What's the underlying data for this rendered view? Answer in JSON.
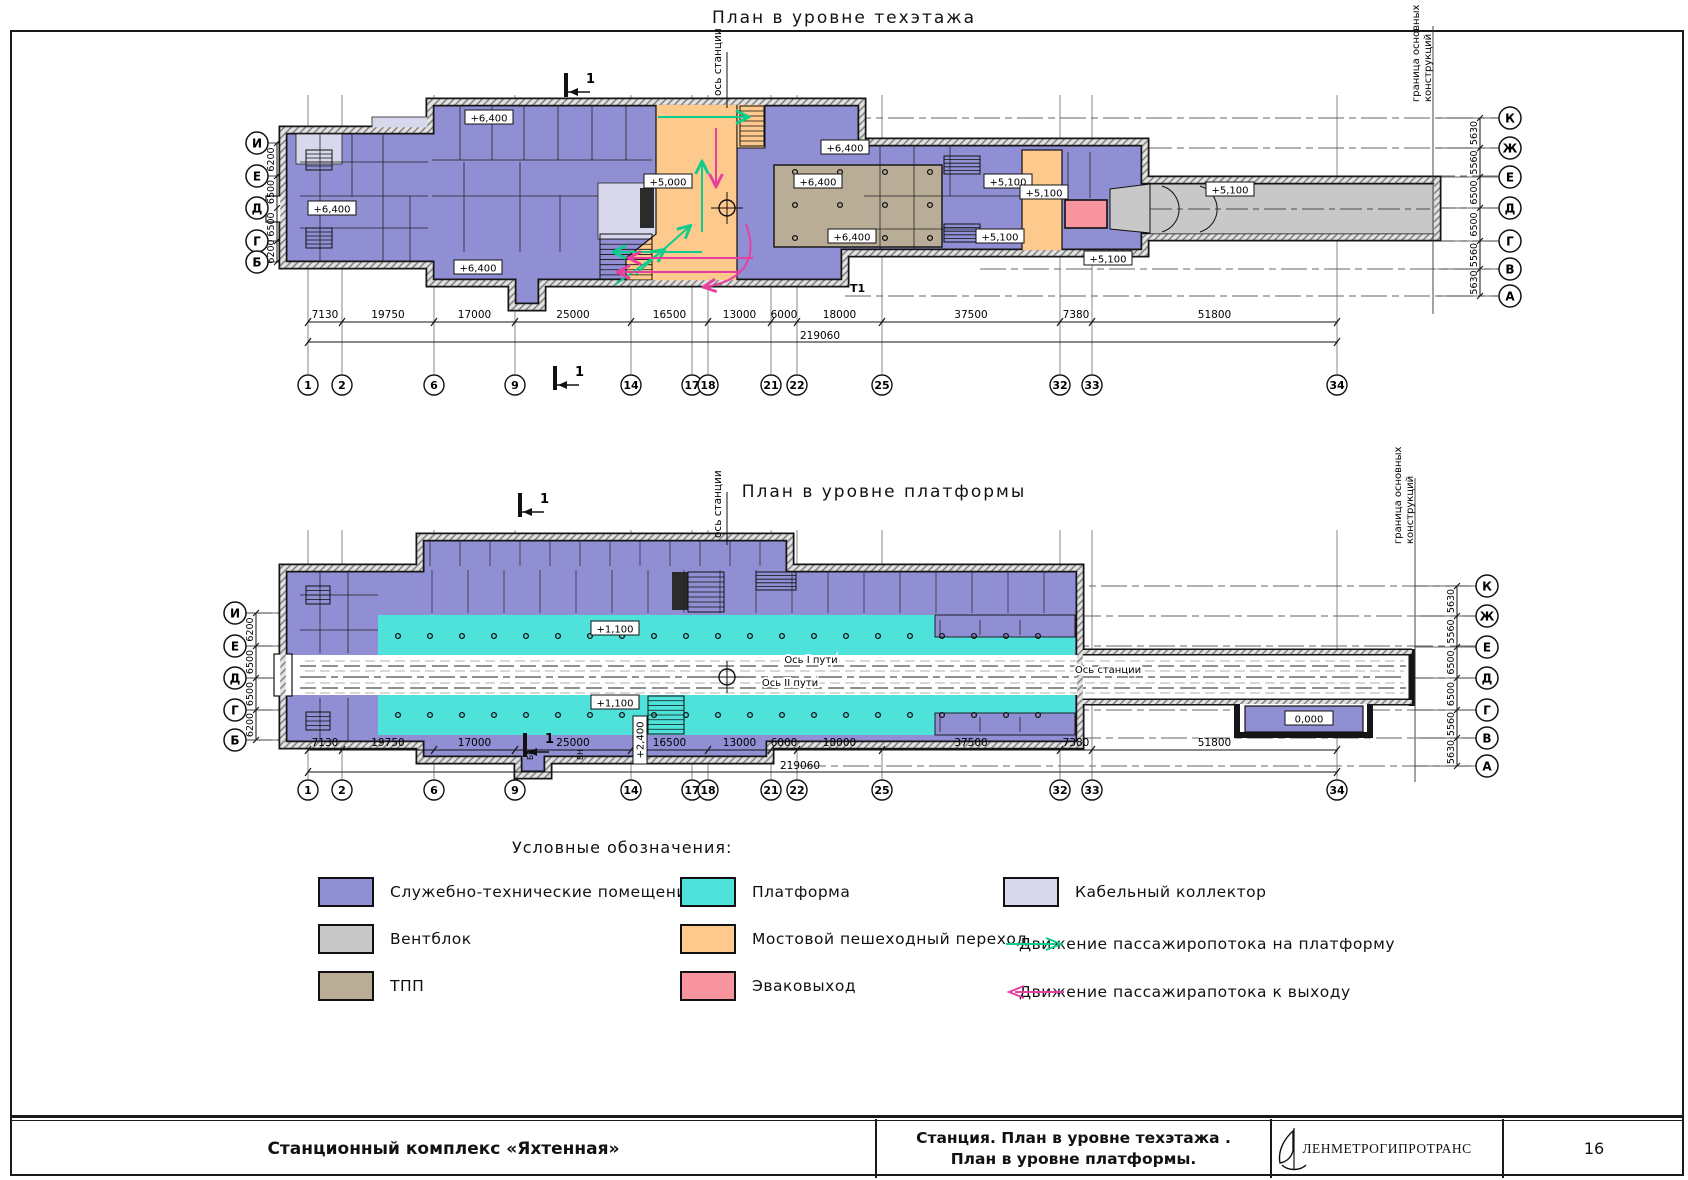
{
  "sheet": {
    "top_plan_title": "План в уровне техэтажа",
    "bottom_plan_title": "План в уровне платформы"
  },
  "top_plan": {
    "station_axis": "ось станции",
    "boundary_line1": "граница основных",
    "boundary_line2": "конструкций",
    "left_axes": [
      "И",
      "Е",
      "Д",
      "Г",
      "Б"
    ],
    "left_dims": [
      "6200",
      "6500",
      "6500",
      "6200"
    ],
    "right_axes": [
      "К",
      "Ж",
      "Е",
      "Д",
      "Г",
      "В",
      "А"
    ],
    "right_dims": [
      "5630",
      "5560",
      "6500",
      "6500",
      "5560",
      "5630"
    ],
    "columns": [
      "1",
      "2",
      "6",
      "9",
      "14",
      "17",
      "18",
      "21",
      "22",
      "25",
      "32",
      "33",
      "34"
    ],
    "dims": [
      "7130",
      "19750",
      "17000",
      "25000",
      "16500",
      "13000",
      "6000",
      "18000",
      "37500",
      "7380",
      "51800"
    ],
    "total_dim": "219060",
    "elevations": [
      "+6,400",
      "+6,400",
      "+6,400",
      "+5,000",
      "+6,400",
      "+6,400",
      "+6,400",
      "+5,100",
      "+5,100",
      "+5,100",
      "+5,100",
      "+5,100"
    ],
    "section_mark": "1",
    "t_mark": "Т1"
  },
  "bottom_plan": {
    "station_axis": "ось станции",
    "boundary_line1": "граница основных",
    "boundary_line2": "конструкций",
    "left_axes": [
      "И",
      "Е",
      "Д",
      "Г",
      "Б"
    ],
    "left_dims": [
      "6200",
      "6500",
      "6500",
      "6200"
    ],
    "right_axes": [
      "К",
      "Ж",
      "Е",
      "Д",
      "Г",
      "В",
      "А"
    ],
    "right_dims": [
      "5630",
      "5560",
      "6500",
      "6500",
      "5560",
      "5630"
    ],
    "columns": [
      "1",
      "2",
      "6",
      "9",
      "14",
      "17",
      "18",
      "21",
      "22",
      "25",
      "32",
      "33",
      "34"
    ],
    "dims": [
      "7130",
      "19750",
      "17000",
      "25000",
      "16500",
      "13000",
      "6000",
      "18000",
      "37500",
      "7380",
      "51800"
    ],
    "total_dim": "219060",
    "elevations": [
      "+1,100",
      "+1,100",
      "+2,400",
      "0,000"
    ],
    "track1_axis": "Ось I пути",
    "track2_axis": "Ось II пути",
    "station_axis_center": "Ось станции",
    "section_mark": "1",
    "mark_bv": "БВ",
    "mark_vn": "ВН"
  },
  "legend": {
    "header": "Условные обозначения:",
    "items": [
      {
        "label": "Служебно-технические помещения",
        "color": "#918fd3"
      },
      {
        "label": "Вентблок",
        "color": "#c8c8c8"
      },
      {
        "label": "ТПП",
        "color": "#b9ad97"
      },
      {
        "label": "Платформа",
        "color": "#4ee2da"
      },
      {
        "label": "Мостовой пешеходный переход",
        "color": "#fdc98c"
      },
      {
        "label": "Эваковыход",
        "color": "#f7949e"
      },
      {
        "label": "Кабельный коллектор",
        "color": "#d8d8ec"
      }
    ],
    "arrows": [
      {
        "label": "Движение пассажиропотока на платформу",
        "color": "#0ecb8e",
        "direction": "right"
      },
      {
        "label": "Движение пассажирапотока к выходу",
        "color": "#e83f9e",
        "direction": "left"
      }
    ]
  },
  "title_block": {
    "project": "Станционный комплекс «Яхтенная»",
    "sheet_title_line1": "Станция. План в уровне техэтажа .",
    "sheet_title_line2": "План в уровне платформы.",
    "company": "ЛЕНМЕТРОГИПРОТРАНС",
    "page_number": "16"
  }
}
